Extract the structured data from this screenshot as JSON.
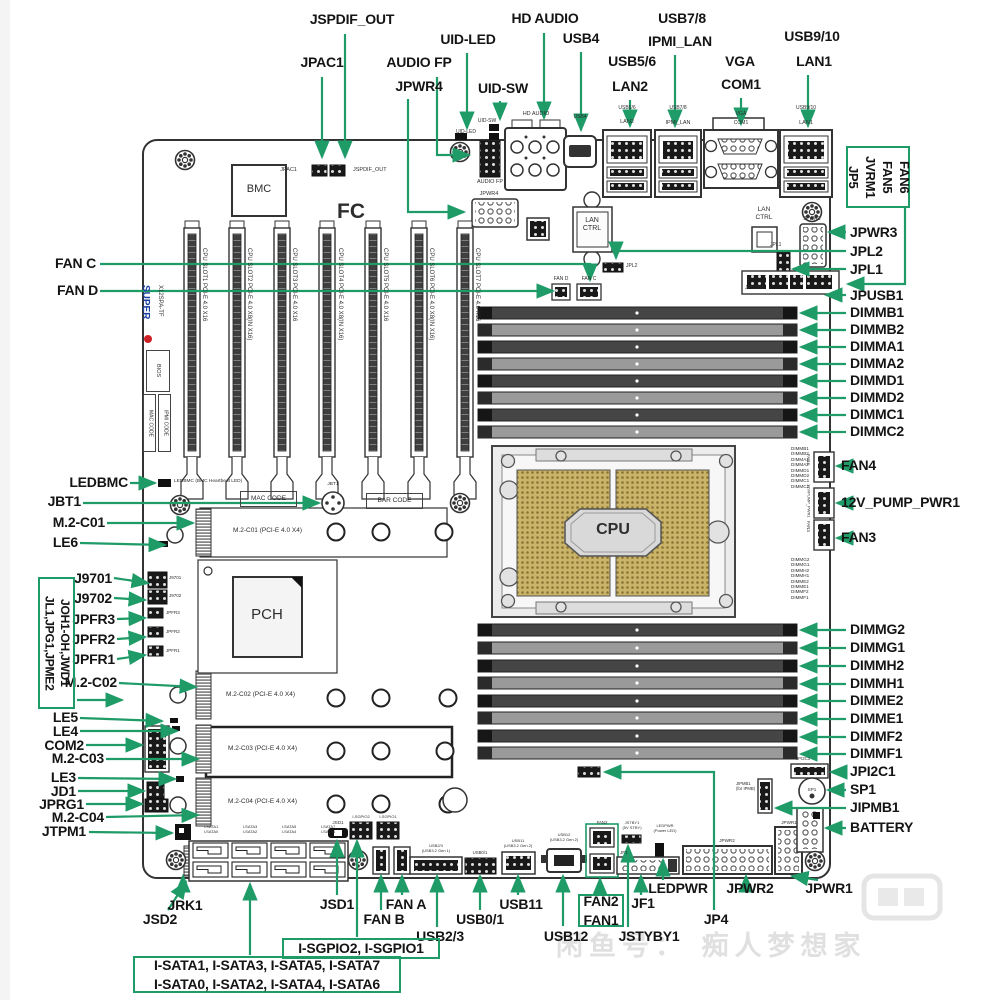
{
  "colors": {
    "leader_green": "#1f9b68",
    "label_text": "#141414",
    "silk_text": "#2e2e2e",
    "gold": "#cab469",
    "logo_blue": "#1a3f9e",
    "logo_red": "#cc2127",
    "watermark_gray": "#e0e0e0"
  },
  "watermark": {
    "text": "闲鱼号： 痴人梦想家"
  },
  "callouts": [
    {
      "id": "jspdif-out",
      "t": "JSPDIF_OUT",
      "x": 352,
      "y": 12,
      "a": "center"
    },
    {
      "id": "jpac1",
      "t": "JPAC1",
      "x": 322,
      "y": 55,
      "a": "center"
    },
    {
      "id": "audio-fp",
      "t": "AUDIO FP",
      "x": 419,
      "y": 55,
      "a": "center"
    },
    {
      "id": "jpwr4",
      "t": "JPWR4",
      "x": 419,
      "y": 79,
      "a": "center"
    },
    {
      "id": "uid-led",
      "t": "UID-LED",
      "x": 468,
      "y": 32,
      "a": "center"
    },
    {
      "id": "uid-sw",
      "t": "UID-SW",
      "x": 503,
      "y": 81,
      "a": "center"
    },
    {
      "id": "hd-audio",
      "t": "HD AUDIO",
      "x": 545,
      "y": 11,
      "a": "center"
    },
    {
      "id": "usb4",
      "t": "USB4",
      "x": 581,
      "y": 31,
      "a": "center"
    },
    {
      "id": "usb5-6",
      "t": "USB5/6",
      "x": 632,
      "y": 54,
      "a": "center"
    },
    {
      "id": "lan2",
      "t": "LAN2",
      "x": 630,
      "y": 79,
      "a": "center"
    },
    {
      "id": "usb7-8",
      "t": "USB7/8",
      "x": 682,
      "y": 11,
      "a": "center"
    },
    {
      "id": "ipmi-lan",
      "t": "IPMI_LAN",
      "x": 680,
      "y": 34,
      "a": "center"
    },
    {
      "id": "vga",
      "t": "VGA",
      "x": 740,
      "y": 54,
      "a": "center"
    },
    {
      "id": "com1",
      "t": "COM1",
      "x": 741,
      "y": 77,
      "a": "center"
    },
    {
      "id": "usb9-10",
      "t": "USB9/10",
      "x": 812,
      "y": 29,
      "a": "center"
    },
    {
      "id": "lan1",
      "t": "LAN1",
      "x": 814,
      "y": 54,
      "a": "center"
    },
    {
      "id": "jp5-box",
      "t": "JP5\nJVRM1\nFAN5\nFAN6",
      "x": 846,
      "y": 146,
      "box": true,
      "v": true,
      "w": 64,
      "h": 62,
      "s": 13
    },
    {
      "id": "jpwr3",
      "t": "JPWR3",
      "x": 850,
      "y": 225
    },
    {
      "id": "jpl2",
      "t": "JPL2",
      "x": 850,
      "y": 244
    },
    {
      "id": "jpl1",
      "t": "JPL1",
      "x": 850,
      "y": 262
    },
    {
      "id": "jpusb1",
      "t": "JPUSB1",
      "x": 850,
      "y": 288
    },
    {
      "id": "dimmb1",
      "t": "DIMMB1",
      "x": 850,
      "y": 305
    },
    {
      "id": "dimmb2",
      "t": "DIMMB2",
      "x": 850,
      "y": 322
    },
    {
      "id": "dimma1",
      "t": "DIMMA1",
      "x": 850,
      "y": 339
    },
    {
      "id": "dimma2",
      "t": "DIMMA2",
      "x": 850,
      "y": 356
    },
    {
      "id": "dimmd1",
      "t": "DIMMD1",
      "x": 850,
      "y": 373
    },
    {
      "id": "dimmd2",
      "t": "DIMMD2",
      "x": 850,
      "y": 390
    },
    {
      "id": "dimmc1",
      "t": "DIMMC1",
      "x": 850,
      "y": 407
    },
    {
      "id": "dimmc2",
      "t": "DIMMC2",
      "x": 850,
      "y": 424
    },
    {
      "id": "fan4",
      "t": "FAN4",
      "x": 841,
      "y": 458
    },
    {
      "id": "pump-pwr1",
      "t": "12V_PUMP_PWR1",
      "x": 841,
      "y": 495
    },
    {
      "id": "fan3",
      "t": "FAN3",
      "x": 841,
      "y": 530
    },
    {
      "id": "dimmg2",
      "t": "DIMMG2",
      "x": 850,
      "y": 622
    },
    {
      "id": "dimmg1",
      "t": "DIMMG1",
      "x": 850,
      "y": 640
    },
    {
      "id": "dimmh2",
      "t": "DIMMH2",
      "x": 850,
      "y": 658
    },
    {
      "id": "dimmh1",
      "t": "DIMMH1",
      "x": 850,
      "y": 676
    },
    {
      "id": "dimme2",
      "t": "DIMME2",
      "x": 850,
      "y": 693
    },
    {
      "id": "dimme1",
      "t": "DIMME1",
      "x": 850,
      "y": 711
    },
    {
      "id": "dimmf2",
      "t": "DIMMF2",
      "x": 850,
      "y": 729
    },
    {
      "id": "dimmf1",
      "t": "DIMMF1",
      "x": 850,
      "y": 746
    },
    {
      "id": "jpi2c1",
      "t": "JPI2C1",
      "x": 850,
      "y": 764
    },
    {
      "id": "sp1",
      "t": "SP1",
      "x": 850,
      "y": 782
    },
    {
      "id": "jipmb1",
      "t": "JIPMB1",
      "x": 850,
      "y": 800
    },
    {
      "id": "battery",
      "t": "BATTERY",
      "x": 850,
      "y": 820
    },
    {
      "id": "fan-c",
      "t": "FAN C",
      "x": 96,
      "y": 256,
      "a": "right"
    },
    {
      "id": "fan-d",
      "t": "FAN D",
      "x": 98,
      "y": 283,
      "a": "right"
    },
    {
      "id": "ledbmc",
      "t": "LEDBMC",
      "x": 128,
      "y": 475,
      "a": "right"
    },
    {
      "id": "jbt1",
      "t": "JBT1",
      "x": 81,
      "y": 494,
      "a": "right"
    },
    {
      "id": "m2-c01",
      "t": "M.2-C01",
      "x": 105,
      "y": 515,
      "a": "right"
    },
    {
      "id": "le6",
      "t": "LE6",
      "x": 78,
      "y": 535,
      "a": "right"
    },
    {
      "id": "j9701",
      "t": "J9701",
      "x": 112,
      "y": 571,
      "a": "right"
    },
    {
      "id": "j9702",
      "t": "J9702",
      "x": 112,
      "y": 591,
      "a": "right"
    },
    {
      "id": "jpfr3",
      "t": "JPFR3",
      "x": 115,
      "y": 612,
      "a": "right"
    },
    {
      "id": "jpfr2",
      "t": "JPFR2",
      "x": 115,
      "y": 632,
      "a": "right"
    },
    {
      "id": "jpfr1",
      "t": "JPFR1",
      "x": 115,
      "y": 652,
      "a": "right"
    },
    {
      "id": "m2-c02",
      "t": "M.2-C02",
      "x": 117,
      "y": 675,
      "a": "right"
    },
    {
      "id": "jl1-box",
      "t": "JL1,JPG1,JPME2\nJOH1-OH,JWD1",
      "x": 38,
      "y": 577,
      "box": true,
      "v": true,
      "w": 37,
      "h": 132,
      "s": 12
    },
    {
      "id": "le5",
      "t": "LE5",
      "x": 78,
      "y": 710,
      "a": "right"
    },
    {
      "id": "le4",
      "t": "LE4",
      "x": 78,
      "y": 724,
      "a": "right"
    },
    {
      "id": "com2",
      "t": "COM2",
      "x": 84,
      "y": 738,
      "a": "right"
    },
    {
      "id": "m2-c03",
      "t": "M.2-C03",
      "x": 104,
      "y": 751,
      "a": "right"
    },
    {
      "id": "le3",
      "t": "LE3",
      "x": 76,
      "y": 770,
      "a": "right"
    },
    {
      "id": "jd1",
      "t": "JD1",
      "x": 76,
      "y": 784,
      "a": "right"
    },
    {
      "id": "jprg1",
      "t": "JPRG1",
      "x": 84,
      "y": 797,
      "a": "right"
    },
    {
      "id": "m2-c04",
      "t": "M.2-C04",
      "x": 104,
      "y": 810,
      "a": "right"
    },
    {
      "id": "jtpm1",
      "t": "JTPM1",
      "x": 86,
      "y": 824,
      "a": "right"
    },
    {
      "id": "jrk1",
      "t": "JRK1",
      "x": 185,
      "y": 898,
      "a": "center"
    },
    {
      "id": "jsd2",
      "t": "JSD2",
      "x": 160,
      "y": 912,
      "a": "center"
    },
    {
      "id": "jsd1",
      "t": "JSD1",
      "x": 337,
      "y": 897,
      "a": "center"
    },
    {
      "id": "fan-a",
      "t": "FAN A",
      "x": 406,
      "y": 897,
      "a": "center"
    },
    {
      "id": "fan-b",
      "t": "FAN B",
      "x": 384,
      "y": 912,
      "a": "center"
    },
    {
      "id": "usb2-3",
      "t": "USB2/3",
      "x": 440,
      "y": 929,
      "a": "center"
    },
    {
      "id": "usb0-1",
      "t": "USB0/1",
      "x": 480,
      "y": 912,
      "a": "center"
    },
    {
      "id": "usb11",
      "t": "USB11",
      "x": 521,
      "y": 897,
      "a": "center"
    },
    {
      "id": "usb12",
      "t": "USB12",
      "x": 566,
      "y": 929,
      "a": "center"
    },
    {
      "id": "fan2-fan1-box",
      "t": "FAN2\nFAN1",
      "x": 578,
      "y": 894,
      "box": true,
      "w": 46,
      "h": 33
    },
    {
      "id": "jf1",
      "t": "JF1",
      "x": 643,
      "y": 896,
      "a": "center"
    },
    {
      "id": "jstyby1",
      "t": "JSTYBY1",
      "x": 649,
      "y": 929,
      "a": "center"
    },
    {
      "id": "jp4",
      "t": "JP4",
      "x": 716,
      "y": 912,
      "a": "center"
    },
    {
      "id": "ledpwr",
      "t": "LEDPWR",
      "x": 678,
      "y": 881,
      "a": "center"
    },
    {
      "id": "jpwr2",
      "t": "JPWR2",
      "x": 750,
      "y": 881,
      "a": "center"
    },
    {
      "id": "jpwr1",
      "t": "JPWR1",
      "x": 829,
      "y": 881,
      "a": "center"
    },
    {
      "id": "sgpio-box",
      "t": "I-SGPIO2, I-SGPIO1",
      "x": 282,
      "y": 938,
      "box": true,
      "w": 158,
      "h": 21
    },
    {
      "id": "sata-box",
      "t": "I-SATA1, I-SATA3, I-SATA5, I-SATA7\nI-SATA0, I-SATA2, I-SATA4, I-SATA6",
      "x": 133,
      "y": 956,
      "box": true,
      "w": 268,
      "h": 37
    }
  ],
  "silk": [
    {
      "t": "JPAC1",
      "x": 297,
      "y": 167,
      "s": 5.5,
      "a": "right"
    },
    {
      "t": "JSPDIF_OUT",
      "x": 353,
      "y": 167,
      "s": 5.5
    },
    {
      "t": "AUDIO FP",
      "x": 490,
      "y": 179,
      "s": 5.5,
      "a": "center"
    },
    {
      "t": "JPWR4",
      "x": 489,
      "y": 191,
      "s": 5.5,
      "a": "center"
    },
    {
      "t": "UID-SW",
      "x": 487,
      "y": 119,
      "s": 5,
      "a": "center"
    },
    {
      "t": "UID-LED",
      "x": 466,
      "y": 130,
      "s": 5,
      "a": "center"
    },
    {
      "t": "HD AUDIO",
      "x": 536,
      "y": 111,
      "s": 5.5,
      "a": "center"
    },
    {
      "t": "USB4",
      "x": 580,
      "y": 115,
      "s": 5,
      "a": "center"
    },
    {
      "t": "USB5/6",
      "x": 627,
      "y": 106,
      "s": 5,
      "a": "center"
    },
    {
      "t": "LAN2",
      "x": 627,
      "y": 119,
      "s": 5.5,
      "a": "center"
    },
    {
      "t": "USB7/8",
      "x": 678,
      "y": 106,
      "s": 5,
      "a": "center"
    },
    {
      "t": "IPMI_LAN",
      "x": 678,
      "y": 120,
      "s": 5.5,
      "a": "center"
    },
    {
      "t": "VGA",
      "x": 741,
      "y": 112,
      "s": 5,
      "a": "center"
    },
    {
      "t": "COM1",
      "x": 741,
      "y": 121,
      "s": 5,
      "a": "center"
    },
    {
      "t": "USB9/10",
      "x": 806,
      "y": 106,
      "s": 5,
      "a": "center"
    },
    {
      "t": "LAN1",
      "x": 806,
      "y": 120,
      "s": 5.5,
      "a": "center"
    },
    {
      "t": "LAN\nCTRL",
      "x": 592,
      "y": 217,
      "s": 7,
      "a": "center"
    },
    {
      "t": "LAN\nCTRL",
      "x": 764,
      "y": 206,
      "s": 6.5,
      "a": "center"
    },
    {
      "t": "JPL2",
      "x": 626,
      "y": 264,
      "s": 5
    },
    {
      "t": "JPL1",
      "x": 770,
      "y": 243,
      "s": 5
    },
    {
      "t": "JPWR3",
      "x": 812,
      "y": 217,
      "s": 5,
      "a": "center"
    },
    {
      "t": "FAN D",
      "x": 561,
      "y": 277,
      "s": 5,
      "a": "center"
    },
    {
      "t": "FAN C",
      "x": 589,
      "y": 277,
      "s": 5,
      "a": "center"
    },
    {
      "t": "JPUSB1",
      "x": 745,
      "y": 286,
      "s": 5
    },
    {
      "t": "BMC",
      "x": 259,
      "y": 183,
      "s": 11,
      "a": "center"
    },
    {
      "t": "FC",
      "x": 351,
      "y": 200,
      "s": 21,
      "a": "center",
      "b": true
    },
    {
      "t": "PCH",
      "x": 267,
      "y": 606,
      "s": 15,
      "a": "center"
    },
    {
      "t": "CPU",
      "x": 613,
      "y": 521,
      "s": 16,
      "a": "center",
      "b": true
    },
    {
      "t": "LEDBMC (BMC Heartbeat LED)",
      "x": 174,
      "y": 479,
      "s": 4.8
    },
    {
      "t": "JBT1",
      "x": 333,
      "y": 482,
      "s": 4.8,
      "a": "center"
    },
    {
      "t": "MAC CODE",
      "x": 240,
      "y": 491,
      "s": 6.5,
      "box": true,
      "w": 57,
      "h": 16
    },
    {
      "t": "BAR CODE",
      "x": 366,
      "y": 493,
      "s": 6.5,
      "box": true,
      "w": 57,
      "h": 16
    },
    {
      "t": "M.2-C01 (PCI-E 4.0 X4)",
      "x": 233,
      "y": 527,
      "s": 6.5
    },
    {
      "t": "M.2-C02 (PCI-E 4.0 X4)",
      "x": 226,
      "y": 691,
      "s": 6.5
    },
    {
      "t": "M.2-C03 (PCI-E 4.0 X4)",
      "x": 228,
      "y": 745,
      "s": 6.5
    },
    {
      "t": "M.2-C04 (PCI-E 4.0 X4)",
      "x": 228,
      "y": 798,
      "s": 6.5
    },
    {
      "t": "J9701",
      "x": 169,
      "y": 575,
      "s": 4.5
    },
    {
      "t": "J9702",
      "x": 169,
      "y": 593,
      "s": 4.5
    },
    {
      "t": "JPFR3",
      "x": 166,
      "y": 610,
      "s": 4.5
    },
    {
      "t": "JPFR2",
      "x": 166,
      "y": 629,
      "s": 4.5
    },
    {
      "t": "JPFR1",
      "x": 166,
      "y": 648,
      "s": 4.5
    },
    {
      "t": "FAN4",
      "x": 806,
      "y": 454,
      "s": 4.3,
      "v": true
    },
    {
      "t": "12V/PUMP_PWR1",
      "x": 806,
      "y": 484,
      "s": 4,
      "v": true
    },
    {
      "t": "FAN3",
      "x": 806,
      "y": 521,
      "s": 4.3,
      "v": true
    },
    {
      "t": "JPI2C1",
      "x": 796,
      "y": 756,
      "s": 4.3
    },
    {
      "t": "SP1",
      "x": 812,
      "y": 787,
      "s": 4.6,
      "a": "center"
    },
    {
      "t": "JIPMB1\n(for IPMB)",
      "x": 736,
      "y": 782,
      "s": 4.2
    },
    {
      "t": "JPWR2",
      "x": 727,
      "y": 838,
      "s": 4.6,
      "a": "center"
    },
    {
      "t": "JPWR1",
      "x": 789,
      "y": 820,
      "s": 4.6,
      "a": "center"
    },
    {
      "t": "JF1",
      "x": 620,
      "y": 850,
      "s": 4.6
    },
    {
      "t": "FAN2",
      "x": 602,
      "y": 820,
      "s": 4.3,
      "a": "center"
    },
    {
      "t": "JSTBY1\n(5V STBY)",
      "x": 632,
      "y": 821,
      "s": 4,
      "a": "center"
    },
    {
      "t": "LEDPWR\n(Power LED)",
      "x": 665,
      "y": 824,
      "s": 4,
      "a": "center"
    },
    {
      "t": "USB12\n(USB3.2 Gen 2)",
      "x": 564,
      "y": 833,
      "s": 4,
      "a": "center"
    },
    {
      "t": "USB11\n(USB3.2 Gen 2)",
      "x": 518,
      "y": 839,
      "s": 4,
      "a": "center"
    },
    {
      "t": "USB0/1",
      "x": 480,
      "y": 850,
      "s": 4.3,
      "a": "center"
    },
    {
      "t": "USB2/3\n(USB3.2 Gen 1)",
      "x": 436,
      "y": 844,
      "s": 4,
      "a": "center"
    },
    {
      "t": "JSD1",
      "x": 338,
      "y": 820,
      "s": 4.6,
      "a": "center"
    },
    {
      "t": "I-SGPIO2",
      "x": 361,
      "y": 815,
      "s": 4,
      "a": "center"
    },
    {
      "t": "I-SGPIO1",
      "x": 388,
      "y": 815,
      "s": 4,
      "a": "center"
    },
    {
      "t": "I-SATA1\nI-SATA0",
      "x": 211,
      "y": 825,
      "s": 4,
      "a": "center"
    },
    {
      "t": "I-SATA3\nI-SATA2",
      "x": 250,
      "y": 825,
      "s": 4,
      "a": "center"
    },
    {
      "t": "I-SATA5\nI-SATA4",
      "x": 289,
      "y": 825,
      "s": 4,
      "a": "center"
    },
    {
      "t": "I-SATA7\nI-SATA6",
      "x": 328,
      "y": 825,
      "s": 4,
      "a": "center"
    },
    {
      "t": "DIMMB1\nDIMMB2\nDIMMA1\nDIMMA2\nDIMMD1\nDIMMD2\nDIMMC1\nDIMMC2",
      "x": 791,
      "y": 446,
      "s": 4.6
    },
    {
      "t": "DIMMG2\nDIMMG1\nDIMMH2\nDIMMH1\nDIMME2\nDIMME1\nDIMMF2\nDIMMF1",
      "x": 791,
      "y": 557,
      "s": 4.6
    },
    {
      "t": "CPU SLOT1 PCI-E 4.0 X16",
      "x": 200,
      "y": 248,
      "s": 6,
      "v": true
    },
    {
      "t": "CPU SLOT2 PCI-E 4.0 X8(IN X16)",
      "x": 245,
      "y": 248,
      "s": 6,
      "v": true
    },
    {
      "t": "CPU SLOT3 PCI-E 4.0 X16",
      "x": 290,
      "y": 248,
      "s": 6,
      "v": true
    },
    {
      "t": "CPU SLOT4 PCI-E 4.0 X8(IN X16)",
      "x": 336,
      "y": 248,
      "s": 6,
      "v": true
    },
    {
      "t": "CPU SLOT5 PCI-E 4.0 X16",
      "x": 381,
      "y": 248,
      "s": 6,
      "v": true
    },
    {
      "t": "CPU SLOT6 PCI-E 4.0 X8(IN X16)",
      "x": 427,
      "y": 248,
      "s": 6,
      "v": true
    },
    {
      "t": "CPU SLOT7 PCI-E 4.0 X16",
      "x": 473,
      "y": 248,
      "s": 6,
      "v": true
    },
    {
      "t": "SUPER",
      "x": 139,
      "y": 285,
      "s": 10,
      "v": true,
      "b": true,
      "c": "#1a3f9e"
    },
    {
      "t": "X12SPA-TF",
      "x": 156,
      "y": 285,
      "s": 6,
      "v": true
    },
    {
      "t": "BIOS",
      "x": 146,
      "y": 350,
      "s": 5.5,
      "v": true,
      "box": true,
      "w": 24,
      "h": 42
    },
    {
      "t": "IPMI CODE",
      "x": 158,
      "y": 394,
      "s": 5,
      "v": true,
      "box": true,
      "w": 13,
      "h": 58
    },
    {
      "t": "MAC CODE",
      "x": 143,
      "y": 394,
      "s": 5,
      "v": true,
      "box": true,
      "w": 13,
      "h": 58
    }
  ]
}
